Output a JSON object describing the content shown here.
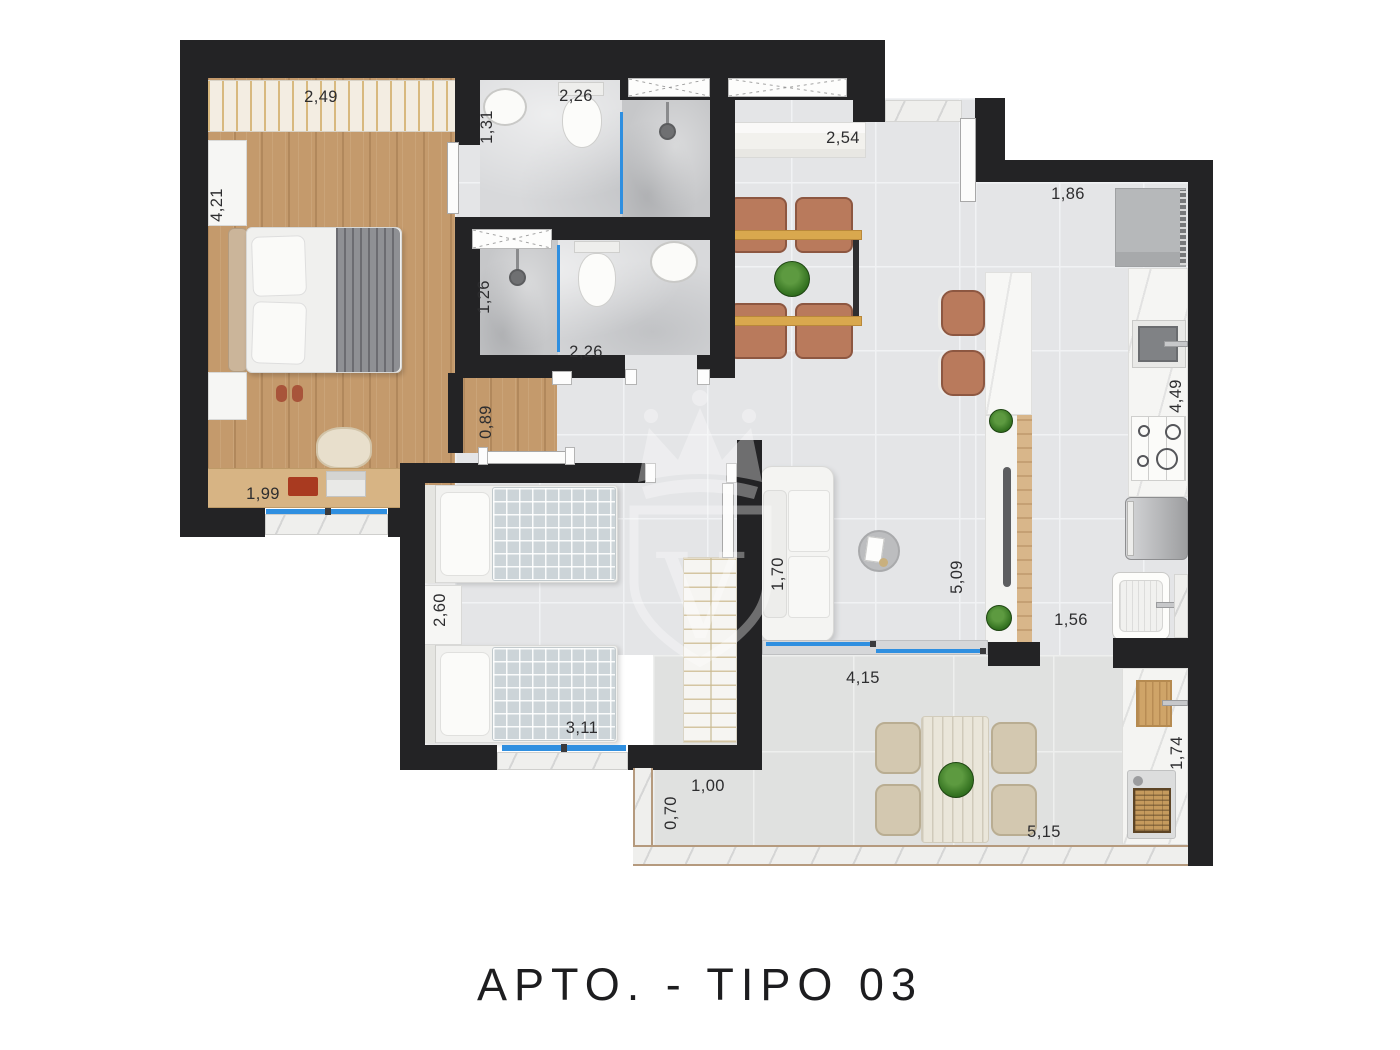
{
  "title": "APTO. - TIPO 03",
  "watermark": {
    "letter": "V",
    "type": "crown-shield-logo"
  },
  "colors": {
    "wall": "#232325",
    "wood_floor": "#c49a6c",
    "tile_floor": "#e4e5e7",
    "glass_accent": "#2f8fe0",
    "leather_chair": "#b97a5c",
    "table_wood": "#d9a84e"
  },
  "dims": {
    "bedroom1_wardrobe": "2,49",
    "bedroom1_depth": "4,21",
    "bedroom1_desk": "1,99",
    "bath1_width": "1,31",
    "bath1_length": "2,26",
    "bath2_width": "1,26",
    "bath2_length": "2,26",
    "hall_width": "0,89",
    "dining_sideboard": "2,54",
    "kitchen_width": "1,86",
    "kitchen_counter": "4,49",
    "service_width": "1,56",
    "living_length": "5,09",
    "sofa_depth": "1,70",
    "bedroom2_nightstand": "2,60",
    "bedroom2_width": "3,11",
    "terrace_living_width": "4,15",
    "terrace_left_width": "1,00",
    "terrace_left_depth": "0,70",
    "terrace_bottom_width": "5,15",
    "terrace_grill_counter": "1,74"
  }
}
